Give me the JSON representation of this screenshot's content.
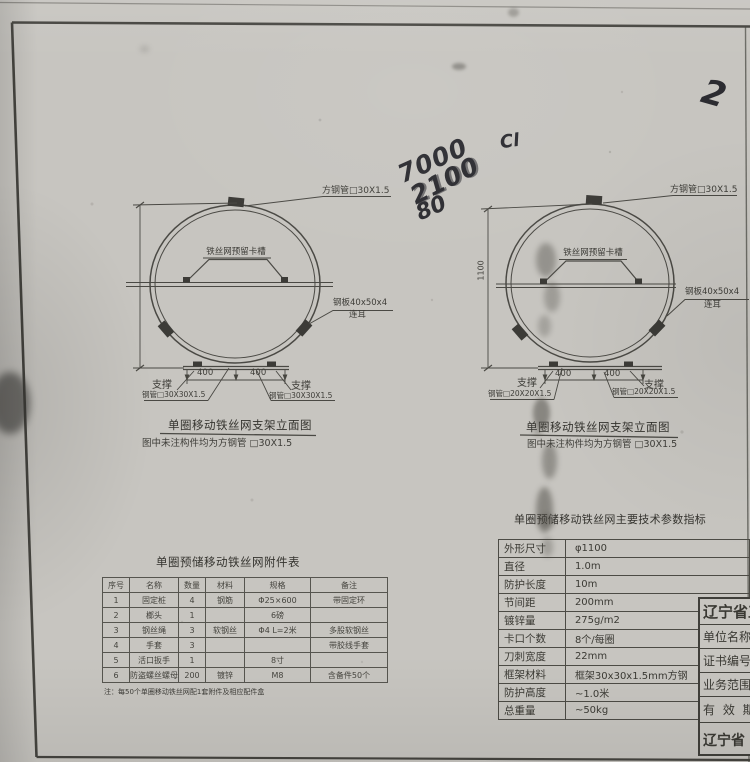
{
  "handwriting": {
    "a": "7000",
    "b": "2100",
    "c": "80",
    "d": "Cl",
    "e": "2"
  },
  "diagram_left": {
    "title": "单圈移动铁丝网支架立面图",
    "subtitle": "图中未注构件均为方钢管 □30X1.5",
    "label_square_tube": "方钢管□30X1.5",
    "label_mesh_slot": "铁丝网预留卡槽",
    "label_plate": "钢板40x50x4",
    "label_plate_lug": "连耳",
    "dim_400_left": "400",
    "dim_400_right": "400",
    "support_left": "支撑",
    "support_right": "支撑",
    "tube_note_left": "钢管□30X30X1.5",
    "tube_note_right": "钢管□30X30X1.5"
  },
  "diagram_right": {
    "title": "单圈移动铁丝网支架立面图",
    "subtitle": "图中未注构件均为方钢管 □30X1.5",
    "label_square_tube": "方钢管□30X1.5",
    "label_mesh_slot": "铁丝网预留卡槽",
    "label_plate": "钢板40x50x4",
    "label_plate_lug": "连耳",
    "dim_height": "1100",
    "dim_400_left": "400",
    "dim_400_right": "400",
    "support_left": "支撑",
    "support_right": "支撑",
    "tube_note_left": "钢管□20X20X1.5",
    "tube_note_right": "钢管□20X20X1.5"
  },
  "attachments_table": {
    "title": "单圈预储移动铁丝网附件表",
    "headers": [
      "序号",
      "名称",
      "数量",
      "材料",
      "规格",
      "备注"
    ],
    "rows": [
      [
        "1",
        "固定桩",
        "4",
        "钢筋",
        "Φ25×600",
        "带固定环"
      ],
      [
        "2",
        "榔头",
        "1",
        "",
        "6磅",
        ""
      ],
      [
        "3",
        "钢丝绳",
        "3",
        "软钢丝",
        "Φ4 L=2米",
        "多股软钢丝"
      ],
      [
        "4",
        "手套",
        "3",
        "",
        "",
        "带胶线手套"
      ],
      [
        "5",
        "活口扳手",
        "1",
        "",
        "8寸",
        ""
      ],
      [
        "6",
        "防盗螺丝螺母",
        "200",
        "镀锌",
        "M8",
        "含备件50个"
      ]
    ],
    "note": "注：每50个单圈移动铁丝网配1套附件及相应配件盒"
  },
  "spec_table": {
    "title": "单圈预储移动铁丝网主要技术参数指标",
    "rows": [
      [
        "外形尺寸",
        "φ1100"
      ],
      [
        "直径",
        "1.0m"
      ],
      [
        "防护长度",
        "10m"
      ],
      [
        "节间距",
        "200mm"
      ],
      [
        "镀锌量",
        "275g/m2"
      ],
      [
        "卡口个数",
        "8个/每圈"
      ],
      [
        "刀刺宽度",
        "22mm"
      ],
      [
        "框架材料",
        "框架30x30x1.5mm方钢"
      ],
      [
        "防护高度",
        "~1.0米"
      ],
      [
        "总重量",
        "~50kg"
      ]
    ]
  },
  "title_block": {
    "rows": [
      "辽宁省工",
      "单位名称",
      "证书编号",
      "业务范围",
      "有 效 期",
      "辽宁省"
    ]
  }
}
